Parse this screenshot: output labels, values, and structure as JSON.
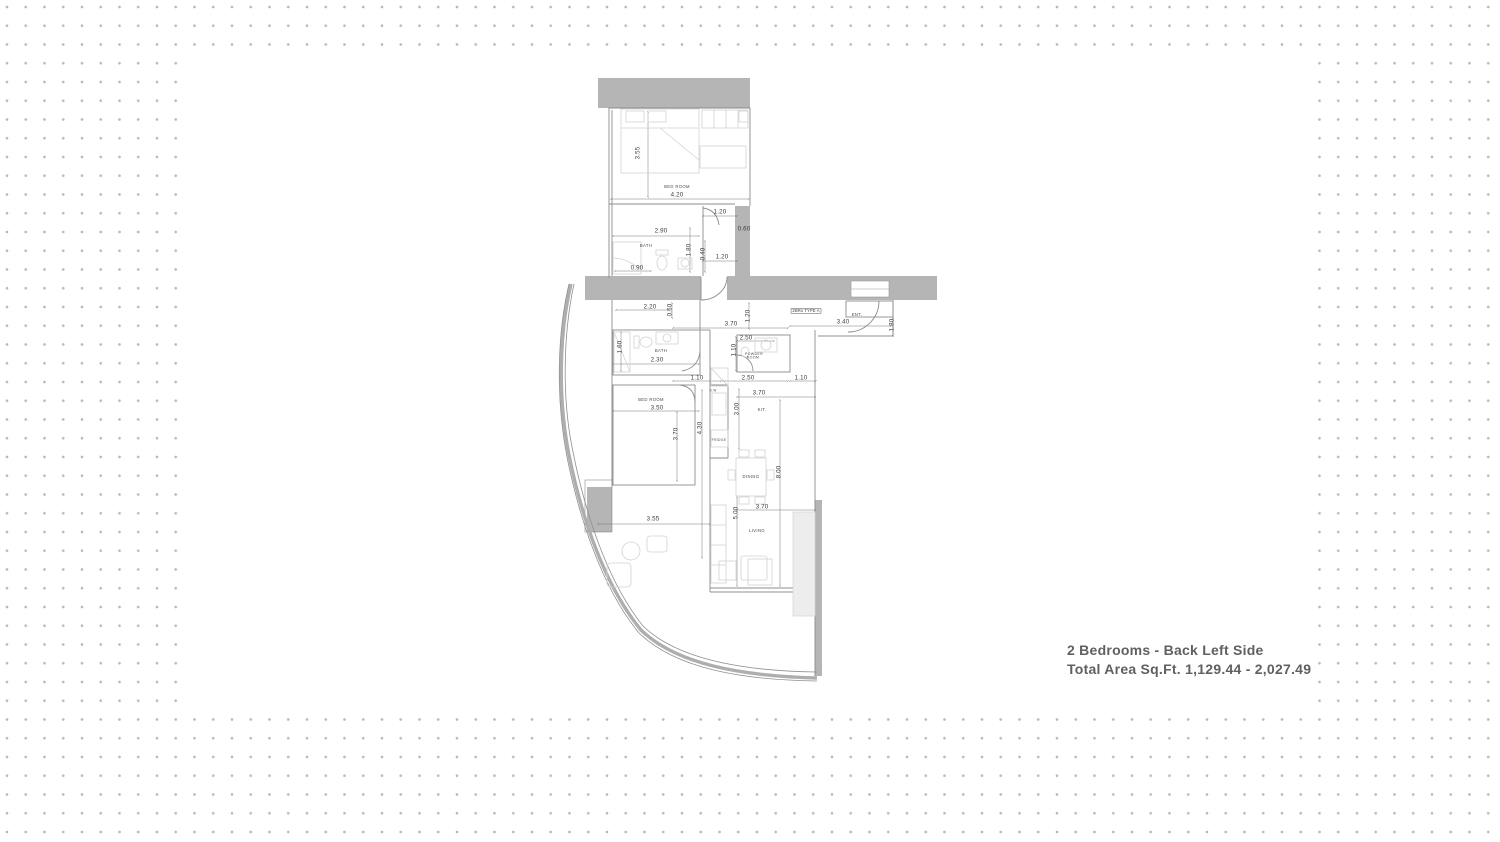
{
  "caption": {
    "line1": "2 Bedrooms - Back Left Side",
    "line2": "Total Area Sq.Ft. 1,129.44 - 2,027.49"
  },
  "colors": {
    "background_dots": "#b9b9b9",
    "panel": "#ffffff",
    "walls": "#b5b5b5",
    "wall_lines": "#8c8c8c",
    "dimension_lines": "#787878",
    "furniture_lines": "#d2d2d2",
    "dimension_text": "#3d3d3d",
    "caption_text": "#5f6062"
  },
  "plan": {
    "unit_type_label": {
      "text": "2BRs TYPE A",
      "x": 806,
      "y": 311,
      "size": 4.2
    },
    "room_labels": [
      {
        "text": "BED ROOM",
        "x": 677,
        "y": 187,
        "size": 4.2
      },
      {
        "text": "BATH",
        "x": 646,
        "y": 246,
        "size": 4.2
      },
      {
        "text": "BATH",
        "x": 661,
        "y": 351,
        "size": 4.2
      },
      {
        "text": "POWDER ROOM",
        "x": 753,
        "y": 356,
        "size": 3.6,
        "wrap": true
      },
      {
        "text": "ENT.",
        "x": 857,
        "y": 315,
        "size": 4.2
      },
      {
        "text": "KIT.",
        "x": 762,
        "y": 410,
        "size": 4.2
      },
      {
        "text": "BED ROOM",
        "x": 651,
        "y": 400,
        "size": 4.2
      },
      {
        "text": "D.W",
        "x": 713,
        "y": 391,
        "size": 3.2
      },
      {
        "text": "FRIDGE",
        "x": 719,
        "y": 440,
        "size": 3.4
      },
      {
        "text": "DINING",
        "x": 751,
        "y": 477,
        "size": 4.2
      },
      {
        "text": "LIVING",
        "x": 757,
        "y": 531,
        "size": 4.2
      }
    ],
    "dim_labels": [
      {
        "text": "3.55",
        "x": 638,
        "y": 153,
        "rot": -90
      },
      {
        "text": "4.20",
        "x": 677,
        "y": 195
      },
      {
        "text": "1.20",
        "x": 720,
        "y": 212
      },
      {
        "text": "2.90",
        "x": 661,
        "y": 231
      },
      {
        "text": "0.60",
        "x": 744,
        "y": 229
      },
      {
        "text": "1.80",
        "x": 689,
        "y": 250,
        "rot": -90
      },
      {
        "text": "0.40",
        "x": 703,
        "y": 254,
        "rot": -90
      },
      {
        "text": "1.20",
        "x": 722,
        "y": 257
      },
      {
        "text": "0.90",
        "x": 637,
        "y": 268
      },
      {
        "text": "2.20",
        "x": 650,
        "y": 307
      },
      {
        "text": "0.60",
        "x": 670,
        "y": 310,
        "rot": -90
      },
      {
        "text": "3.70",
        "x": 731,
        "y": 324
      },
      {
        "text": "1.20",
        "x": 748,
        "y": 316,
        "rot": -90
      },
      {
        "text": "3.40",
        "x": 843,
        "y": 322
      },
      {
        "text": "1.80",
        "x": 892,
        "y": 325,
        "rot": -90
      },
      {
        "text": "1.60",
        "x": 620,
        "y": 347,
        "rot": -90
      },
      {
        "text": "2.30",
        "x": 657,
        "y": 360
      },
      {
        "text": "2.50",
        "x": 746,
        "y": 338
      },
      {
        "text": "1.10",
        "x": 734,
        "y": 350,
        "rot": -90
      },
      {
        "text": "1.10",
        "x": 697,
        "y": 378
      },
      {
        "text": "2.50",
        "x": 748,
        "y": 378
      },
      {
        "text": "1.10",
        "x": 801,
        "y": 378
      },
      {
        "text": "3.70",
        "x": 759,
        "y": 393
      },
      {
        "text": "3.00",
        "x": 737,
        "y": 409,
        "rot": -90
      },
      {
        "text": "3.50",
        "x": 657,
        "y": 408
      },
      {
        "text": "3.70",
        "x": 676,
        "y": 434,
        "rot": -90
      },
      {
        "text": "4.30",
        "x": 700,
        "y": 428,
        "rot": -90
      },
      {
        "text": "8.00",
        "x": 779,
        "y": 472,
        "rot": -90
      },
      {
        "text": "3.70",
        "x": 762,
        "y": 507
      },
      {
        "text": "5.00",
        "x": 736,
        "y": 513,
        "rot": -90
      },
      {
        "text": "3.55",
        "x": 653,
        "y": 519
      }
    ]
  }
}
